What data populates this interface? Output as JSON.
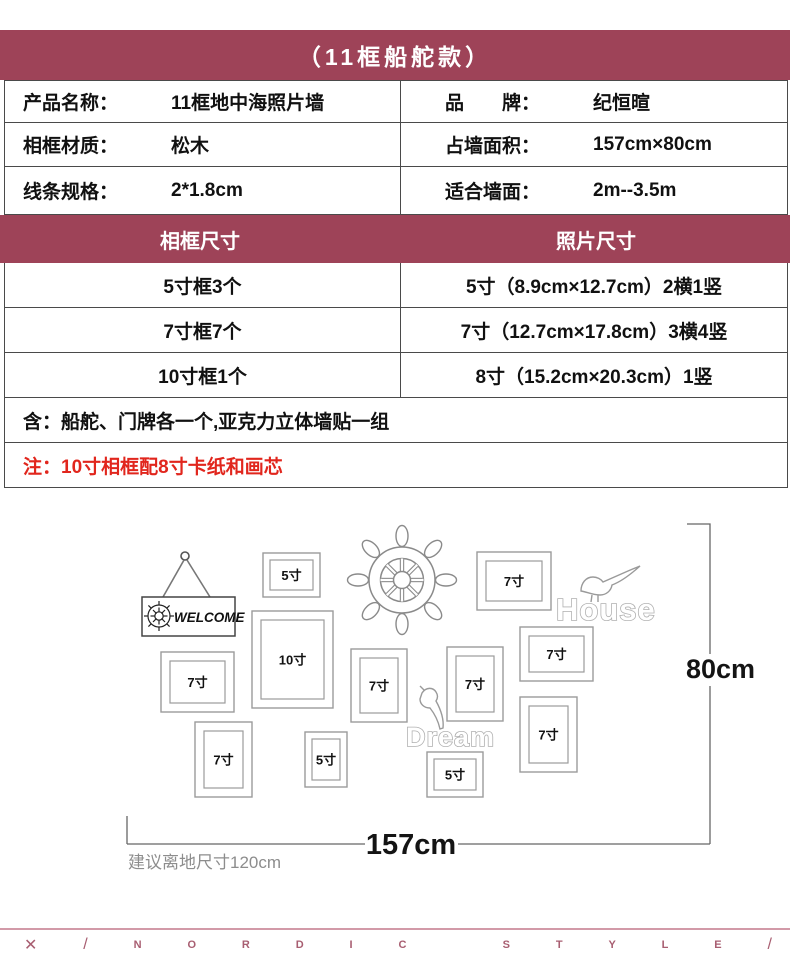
{
  "header": {
    "title": "（11框船舵款）",
    "accent_color": "#9e4358"
  },
  "spec_table": {
    "rows": [
      {
        "label_left": "产品名称：",
        "value_left": "11框地中海照片墙",
        "label_right": "品　　牌：",
        "value_right": "纪恒暄"
      },
      {
        "label_left": "相框材质：",
        "value_left": "松木",
        "label_right": "占墙面积：",
        "value_right": "157cm×80cm"
      },
      {
        "label_left": "线条规格：",
        "value_left": "2*1.8cm",
        "label_right": "适合墙面：",
        "value_right": "2m--3.5m"
      }
    ],
    "size_header": {
      "left": "相框尺寸",
      "right": "照片尺寸"
    },
    "size_rows": [
      {
        "left": "5寸框3个",
        "right": "5寸（8.9cm×12.7cm）2横1竖"
      },
      {
        "left": "7寸框7个",
        "right": "7寸（12.7cm×17.8cm）3横4竖"
      },
      {
        "left": "10寸框1个",
        "right": "8寸（15.2cm×20.3cm）1竖"
      }
    ],
    "includes": "含：船舵、门牌各一个,亚克力立体墙贴一组",
    "note": "注：10寸相框配8寸卡纸和画芯",
    "note_color": "#e1261d"
  },
  "diagram": {
    "welcome_text": "WELCOME",
    "house_text": "House",
    "dream_text": "Dream",
    "height_label": "80cm",
    "width_label": "157cm",
    "floor_note": "建议离地尺寸120cm",
    "frames": [
      {
        "label": "5寸",
        "x": 263,
        "y": 59,
        "w": 57,
        "h": 44
      },
      {
        "label": "7寸",
        "x": 477,
        "y": 58,
        "w": 74,
        "h": 58
      },
      {
        "label": "10寸",
        "x": 252,
        "y": 117,
        "w": 81,
        "h": 97
      },
      {
        "label": "7寸",
        "x": 161,
        "y": 158,
        "w": 73,
        "h": 60
      },
      {
        "label": "7寸",
        "x": 351,
        "y": 155,
        "w": 56,
        "h": 73
      },
      {
        "label": "7寸",
        "x": 447,
        "y": 153,
        "w": 56,
        "h": 74
      },
      {
        "label": "7寸",
        "x": 520,
        "y": 133,
        "w": 73,
        "h": 54
      },
      {
        "label": "7寸",
        "x": 520,
        "y": 203,
        "w": 57,
        "h": 75
      },
      {
        "label": "7寸",
        "x": 195,
        "y": 228,
        "w": 57,
        "h": 75
      },
      {
        "label": "5寸",
        "x": 305,
        "y": 238,
        "w": 42,
        "h": 55
      },
      {
        "label": "5寸",
        "x": 427,
        "y": 258,
        "w": 56,
        "h": 45
      }
    ]
  },
  "footer": {
    "letters": "✕/NORDIC STYLE/",
    "color": "#a85e71"
  }
}
